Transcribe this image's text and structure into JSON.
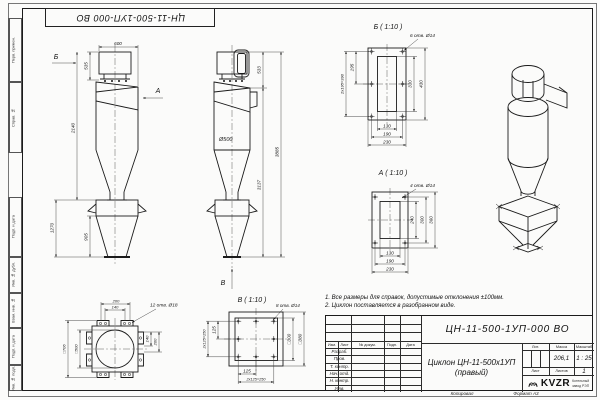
{
  "sheet": {
    "stamp_top": "ЦН-11-500-1УП-000 ВО",
    "left_labels": [
      "Перв. примен.",
      "Справ. №",
      "Подп. и дата",
      "Инв. № дубл.",
      "Взам. инв. №",
      "Подп. и дата",
      "Инв. № подл."
    ],
    "copied": "Копировал",
    "format": "Формат А3"
  },
  "notes": {
    "line1": "1. Все размеры для справок, допустимые отклонения ±100мм.",
    "line2": "2. Циклон поставляется в разобранном виде."
  },
  "side_view": {
    "arrow_b": "Б",
    "arrow_a": "А",
    "dim_top_width": "600",
    "dim_inlet_height": "535",
    "dim_body_height": "2140",
    "dim_bunker_total": "1270",
    "dim_bunker_cone": "905"
  },
  "front_view": {
    "dia_body": "Ø500",
    "dim_outlet": "533",
    "dim_inner_height": "3137",
    "dim_total_height": "3885",
    "arrow_v": "В"
  },
  "detail_b": {
    "title": "Б ( 1:10 )",
    "holes_note": "6 отв. Ø14",
    "dim_195": "195",
    "dim_390": "2х195=390",
    "dim_330": "330",
    "dim_430": "430",
    "dim_130": "130",
    "dim_190": "190",
    "dim_230": "230"
  },
  "detail_a": {
    "title": "А ( 1:10 )",
    "holes_note": "4 отв. Ø14",
    "dim_240": "240",
    "dim_300": "300",
    "dim_360": "360",
    "dim_130": "130",
    "dim_190": "190",
    "dim_230": "230"
  },
  "detail_v": {
    "title": "В ( 1:10 )",
    "holes_note": "8 отв. Ø14",
    "dim_125_left": "125",
    "dim_250_left": "2х125=250",
    "dim_125_bottom": "125",
    "dim_250_bottom": "2х125=250",
    "dim_sq300": "□300",
    "dim_sq380": "□380"
  },
  "flange_detail": {
    "holes_note": "12 отв. Ø18",
    "dim_200_top": "200",
    "dim_140_top": "140",
    "dim_sq706": "□706",
    "dim_sq500": "□500",
    "dim_140_right": "140",
    "dim_200_right": "200"
  },
  "title_block": {
    "doc_number": "ЦН-11-500-1УП-000 ВО",
    "product_name": "Циклон ЦН-11-500х1УП",
    "product_variant": "(правый)",
    "header_izm": "Изм.",
    "header_list": "Лист",
    "header_doc": "№ докум.",
    "header_sign": "Подп.",
    "header_date": "Дата",
    "roles": [
      "Разраб.",
      "Пров.",
      "Т. контр.",
      "Нач. отд.",
      "Н. контр.",
      "Утв."
    ],
    "lit_label": "Лит.",
    "mass_label": "Масса",
    "scale_label": "Масштаб",
    "mass_value": "206,1",
    "scale_value": "1 : 25",
    "sheet_label": "Лист",
    "sheets_label": "Листов",
    "sheets_value": "1",
    "org_logo": "KVZR",
    "org_line1": "Котельный",
    "org_line2": "завод РЭП"
  }
}
